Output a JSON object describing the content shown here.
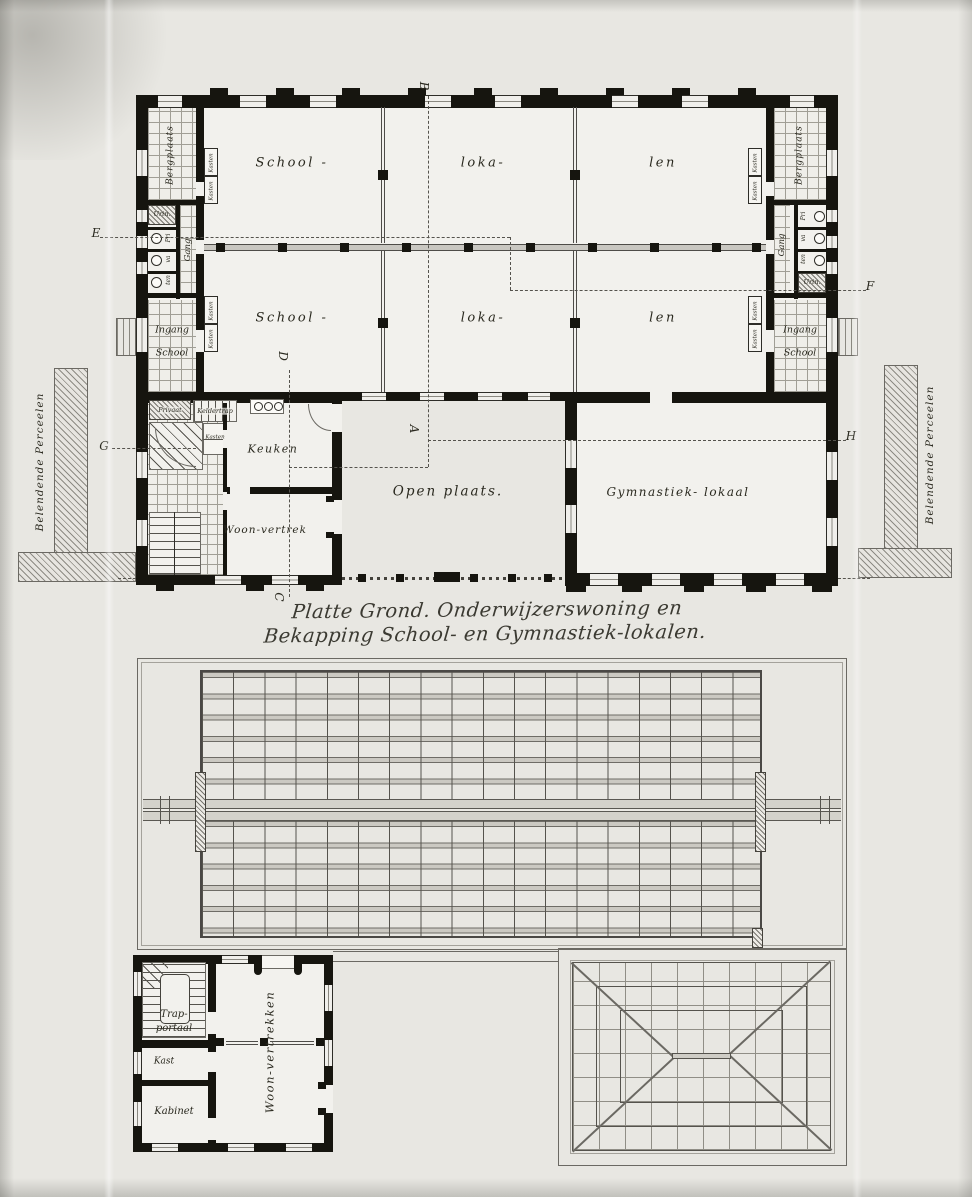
{
  "title": {
    "line1": "Platte Grond. Onderwijzerswoning en",
    "line2": "Bekapping School- en Gymnastiek-lokalen."
  },
  "ground_plan": {
    "classroom_row_top": [
      "School -",
      "loka-",
      "len"
    ],
    "classroom_row_bottom": [
      "School -",
      "loka-",
      "len"
    ],
    "left_wing": {
      "bergplaats": "Bergplaats",
      "urinoir": "Urin.",
      "privaten": [
        "Pri",
        "va",
        "ten"
      ],
      "gang": "Gang",
      "ingang_line1": "Ingang",
      "ingang_line2": "School"
    },
    "right_wing": {
      "bergplaats": "Bergplaats",
      "urinoir": "Urin.",
      "privaten": [
        "Pri",
        "va",
        "ten"
      ],
      "gang": "Gang",
      "ingang_line1": "Ingang",
      "ingang_line2": "School"
    },
    "kasten_label": "Kasten",
    "dwelling": {
      "privaat": "Privaat",
      "keldertrap": "Keldertrap",
      "kasten": "Kasten",
      "keuken": "Keuken",
      "woonvertrek": "Woon-vertrek"
    },
    "courtyard": "Open plaats.",
    "gymnasium": "Gymnastiek- lokaal",
    "parcel_left": "Belendende Perceelen",
    "parcel_right": "Belendende Perceelen",
    "markers": {
      "A": "A",
      "B": "B",
      "C": "C",
      "D": "D",
      "E": "E",
      "F": "F",
      "G": "G",
      "H": "H"
    }
  },
  "roof_plan": {
    "upper_floor": {
      "trap_line1": "Trap-",
      "trap_line2": "portaal",
      "kast": "Kast",
      "kabinet": "Kabinet",
      "woonvertrekken": "Woon-vertrekken"
    }
  }
}
